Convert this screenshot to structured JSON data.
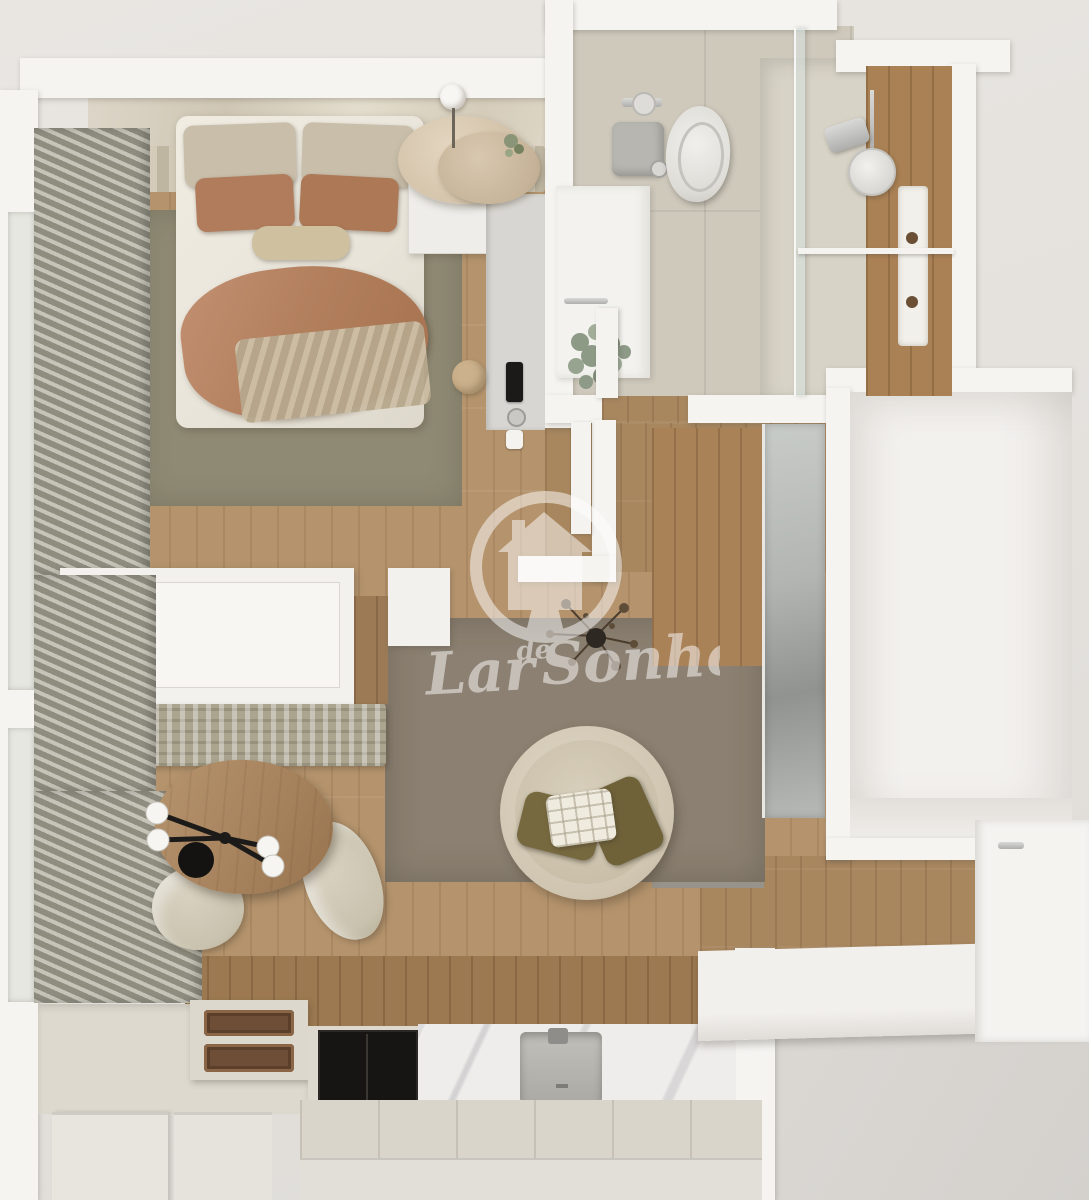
{
  "watermark": {
    "word1": "Lar",
    "word2": "de",
    "word3": "Sonho",
    "icon": "house-in-circle-with-keyhole",
    "color": "#ffffff",
    "opacity": 0.5
  },
  "scene": {
    "type": "3d-rendered-floor-plan-top-view",
    "property": "studio-apartment"
  },
  "palette": {
    "background": "#e7e4e0",
    "exterior_ground": "#d7d4d0",
    "wall": "#f5f4f1",
    "wood_floor": "#b5946d",
    "wood_floor_dark": "#a8875f",
    "wood_wall": "#9c7950",
    "bedroom_rug": "#8f8a74",
    "living_rug": "#8b8071",
    "bathroom_tile": "#cfc9bc",
    "duvet": "#ece8dd",
    "pillow_beige": "#c8bea9",
    "terracotta": "#b37e5d",
    "curtain": "#a9a79a",
    "shower_wood": "#aa8154",
    "mirror": "#b2b5b1",
    "kitchen_cream": "#ddd9cf",
    "marble": "#efedeb",
    "appliance_black": "#171513",
    "table_wood": "#a98663",
    "chair_fabric": "#cfc8b6",
    "olive_cushion": "#77693f",
    "chrome": "#c2c2c0"
  },
  "rooms": {
    "bedroom": {
      "items": [
        "double-bed",
        "beige-pillows",
        "terracotta-pillows",
        "lumbar-pillow",
        "terracotta-throw",
        "olive-area-rug",
        "slatted-headboard-panel",
        "marble-feature-wall",
        "nightstand",
        "double-disc-floor-lamp",
        "pendant-bulb",
        "desk-ledge",
        "phone",
        "cup",
        "jute-pouf",
        "curtains",
        "window"
      ]
    },
    "bathroom": {
      "items": [
        "wall-hung-toilet",
        "cistern",
        "toilet-paper-holder",
        "vanity",
        "towel-rail",
        "eucalyptus-plant",
        "walk-in-shower",
        "glass-partition",
        "rain-shower-head",
        "shower-valve",
        "towel-bar",
        "wood-feature-wall",
        "shower-niche",
        "door"
      ]
    },
    "hallway": {
      "items": [
        "mirrored-wardrobe",
        "wood-panel",
        "grey-floor-mat"
      ]
    },
    "living": {
      "items": [
        "round-lounge-chair",
        "olive-cushions",
        "quilted-throw",
        "taupe-area-rug",
        "dried-plant-arrangement",
        "white-sideboard",
        "patterned-bench"
      ]
    },
    "dining": {
      "items": [
        "oval-wood-table",
        "fabric-chair-right",
        "fabric-chair-bottom",
        "black-multi-arm-chandelier"
      ]
    },
    "kitchen": {
      "items": [
        "two-burner-bronze-hob",
        "black-built-in-cooktop",
        "marble-backsplash",
        "undermount-sink",
        "faucet",
        "counter-run",
        "base-cabinet-1",
        "base-cabinet-2",
        "wood-wall-panel"
      ]
    },
    "entry": {
      "items": [
        "front-door",
        "door-handle",
        "step-platform",
        "exterior-ground"
      ]
    },
    "alcove": {
      "items": [
        "empty-white-recess"
      ]
    }
  }
}
